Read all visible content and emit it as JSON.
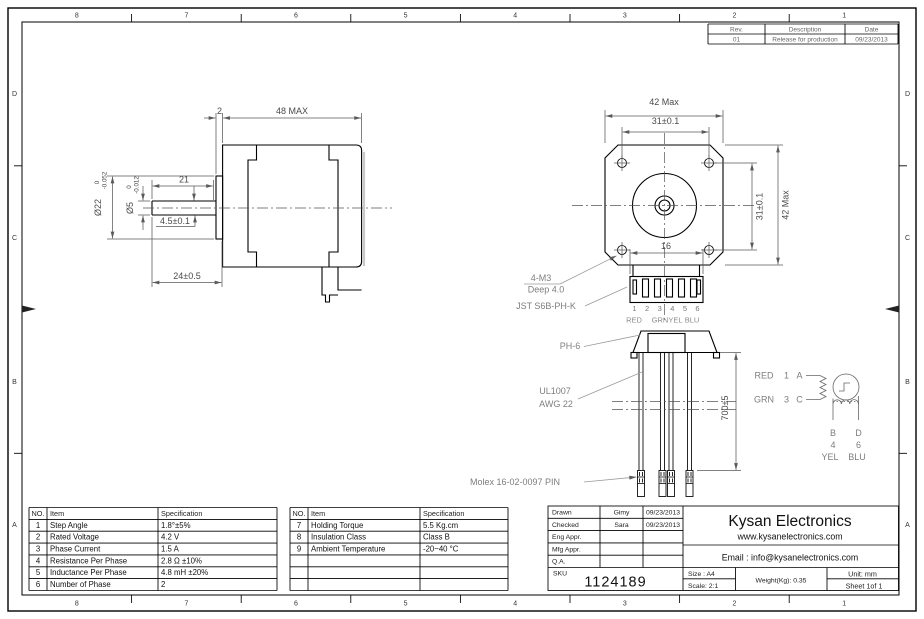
{
  "frame": {
    "zones_top": [
      "8",
      "7",
      "6",
      "5",
      "4",
      "3",
      "2",
      "1"
    ],
    "zones_bottom": [
      "8",
      "7",
      "6",
      "5",
      "4",
      "3",
      "2",
      "1"
    ],
    "zones_left": [
      "D",
      "C",
      "B",
      "A"
    ],
    "zones_right": [
      "D",
      "C",
      "B",
      "A"
    ]
  },
  "revision_table": {
    "headers": [
      "Rev.",
      "Description",
      "Date"
    ],
    "row": [
      "01",
      "Release for production",
      "09/23/2013"
    ]
  },
  "side_view": {
    "dim_plate": "2",
    "dim_body": "48 MAX",
    "dim_shaft_flat": "21",
    "dim_flat": "4.5±0.1",
    "dim_shaft": "24±0.5",
    "boss_dia": {
      "v": "Ø22",
      "tol_up": "0",
      "tol_dn": "-0.052"
    },
    "shaft_dia": {
      "v": "Ø5",
      "tol_up": "0",
      "tol_dn": "-0.012"
    }
  },
  "front_view": {
    "dim_width": "42 Max",
    "dim_holes_h": "31±0.1",
    "dim_holes_v": "31±0.1",
    "dim_height": "42 Max",
    "dim_conn": "16",
    "note_m3": "4-M3",
    "note_m3_2": "Deep 4.0",
    "note_jst": "JST S6B-PH-K",
    "pins": [
      "1",
      "2",
      "3",
      "4",
      "5",
      "6"
    ],
    "wire_colors": [
      "RED",
      "GRN",
      "YEL",
      "BLU"
    ]
  },
  "cable": {
    "note_conn": "PH-6",
    "note_wire1": "UL1007",
    "note_wire2": "AWG 22",
    "dim_len": "700±5",
    "note_pins": "Molex 16-02-0097 PIN"
  },
  "schematic": {
    "red": "RED",
    "n1": "1",
    "a": "A",
    "grn": "GRN",
    "n3": "3",
    "c": "C",
    "b": "B",
    "d": "D",
    "n4": "4",
    "n6": "6",
    "yel": "YEL",
    "blu": "BLU"
  },
  "spec_table_left": {
    "headers": [
      "NO.",
      "Item",
      "Specification"
    ],
    "rows": [
      [
        "1",
        "Step Angle",
        "1.8°±5%"
      ],
      [
        "2",
        "Rated Voltage",
        "4.2 V"
      ],
      [
        "3",
        "Phase Current",
        "1.5 A"
      ],
      [
        "4",
        "Resistance Per Phase",
        "2.8 Ω ±10%"
      ],
      [
        "5",
        "Inductance Per Phase",
        "4.8 mH ±20%"
      ],
      [
        "6",
        "Number of Phase",
        "2"
      ]
    ]
  },
  "spec_table_right": {
    "headers": [
      "NO.",
      "Item",
      "Specification"
    ],
    "rows": [
      [
        "7",
        "Holding Torque",
        "5.5 Kg.cm"
      ],
      [
        "8",
        "Insulation Class",
        "Class B"
      ],
      [
        "9",
        "Ambient Temperature",
        "-20~40 °C"
      ]
    ]
  },
  "title_block": {
    "drawn_label": "Drawn",
    "drawn_name": "Gimy",
    "drawn_date": "09/23/2013",
    "checked_label": "Checked",
    "checked_name": "Sara",
    "checked_date": "09/23/2013",
    "eng_label": "Eng Appr.",
    "mfg_label": "Mfg Appr.",
    "qa_label": "Q.A.",
    "sku_label": "SKU",
    "sku_value": "1124189",
    "company": "Kysan Electronics",
    "website": "www.kysanelectronics.com",
    "email": "Email : info@kysanelectronics.com",
    "size": "Size : A4",
    "scale": "Scale: 2:1",
    "weight": "Weight(Kg):  0.35",
    "unit": "Unit: mm",
    "sheet": "Sheet 1of 1"
  }
}
